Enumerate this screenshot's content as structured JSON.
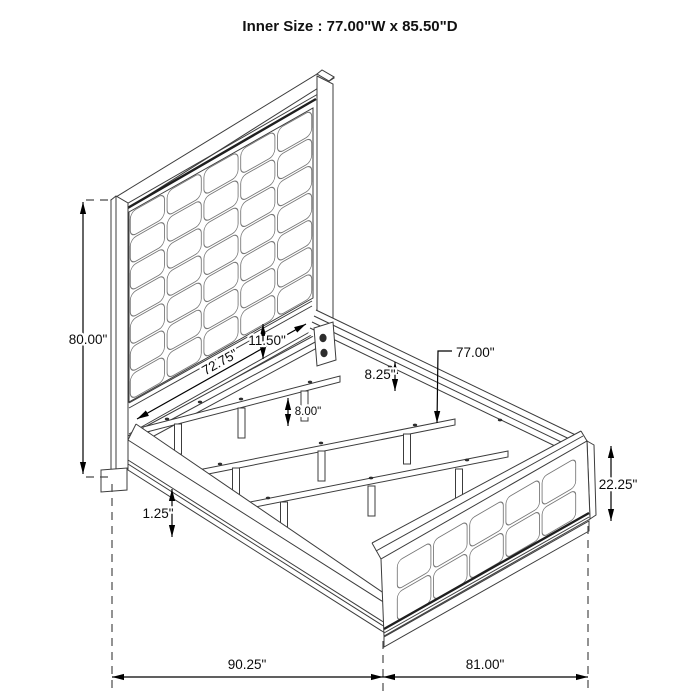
{
  "title": "Inner Size : 77.00\"W x 85.50\"D",
  "dimensions": {
    "headboard_height": "80.00\"",
    "headboard_width": "72.75\"",
    "headboard_panel_gap": "11.50\"",
    "side_rail_height": "8.25\"",
    "support_leg_height": "8.00\"",
    "slat_width": "77.00\"",
    "footboard_height": "22.25\"",
    "side_rail_trim": "1.25\"",
    "overall_depth": "90.25\"",
    "overall_width": "81.00\""
  },
  "colors": {
    "line": "#3c3c3c",
    "dimension": "#000000",
    "background": "#ffffff"
  }
}
